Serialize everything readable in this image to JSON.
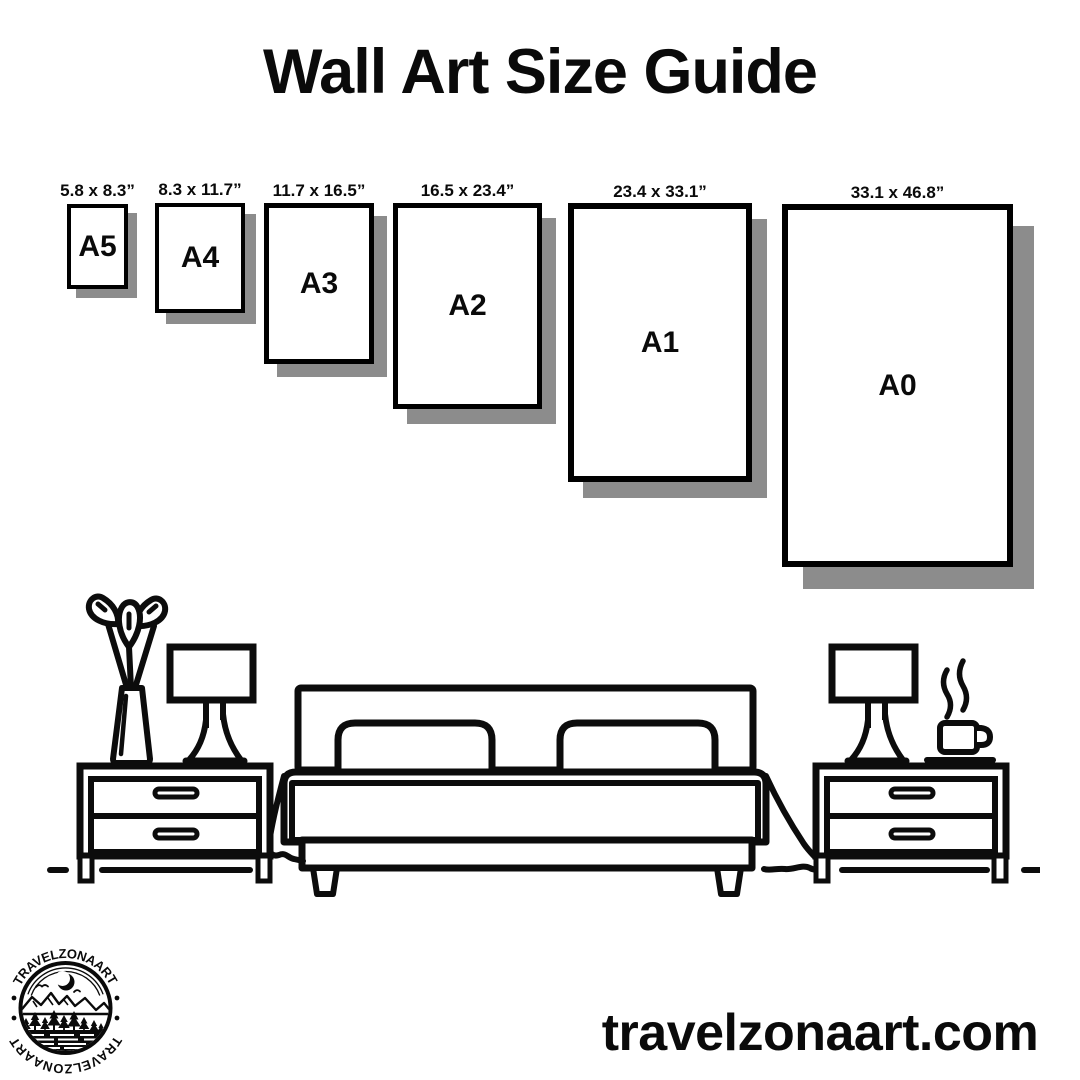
{
  "title": "Wall Art Size Guide",
  "sizes": [
    {
      "name": "A5",
      "dimensions": "5.8 x 8.3”"
    },
    {
      "name": "A4",
      "dimensions": "8.3 x 11.7”"
    },
    {
      "name": "A3",
      "dimensions": "11.7 x 16.5”"
    },
    {
      "name": "A2",
      "dimensions": "16.5 x 23.4”"
    },
    {
      "name": "A1",
      "dimensions": "23.4 x 33.1”"
    },
    {
      "name": "A0",
      "dimensions": "33.1 x 46.8”"
    }
  ],
  "logo": {
    "brand_top": "TRAVELZONAART",
    "brand_bottom": "TRAVELZONAART"
  },
  "footer": {
    "website": "travelzonaart.com"
  },
  "colors": {
    "ink": "#000000",
    "shadow": "#8c8c8c",
    "background": "#ffffff"
  }
}
